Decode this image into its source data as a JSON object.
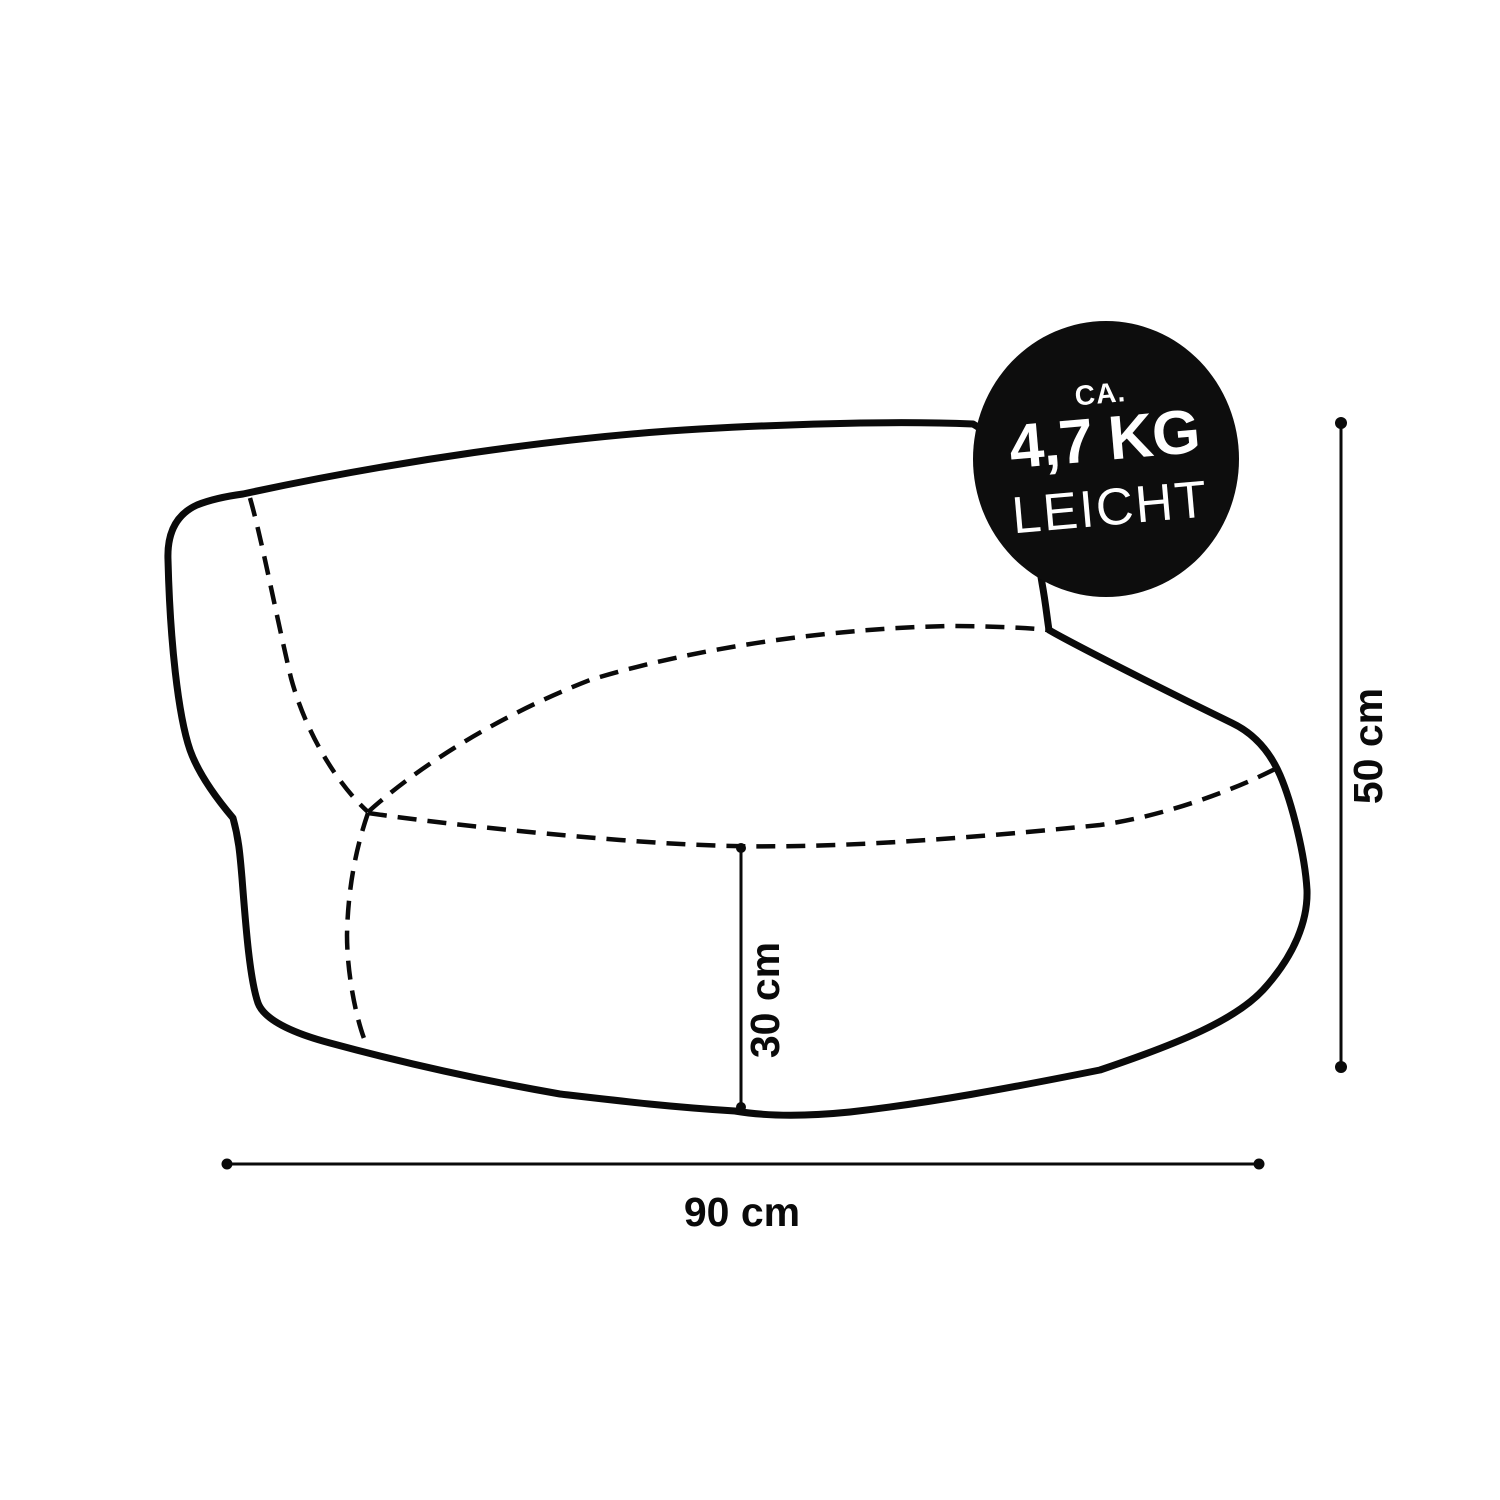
{
  "page": {
    "background_color": "#ffffff",
    "line_color": "#0a0a0a"
  },
  "badge": {
    "prefix": "CA.",
    "weight": "4,7 KG",
    "suffix": "LEICHT",
    "background_color": "#0d0d0d",
    "text_color": "#ffffff"
  },
  "dimensions": {
    "height": {
      "label": "50 cm",
      "orientation": "vertical"
    },
    "seat_height": {
      "label": "30 cm",
      "orientation": "vertical"
    },
    "width": {
      "label": "90 cm",
      "orientation": "horizontal"
    }
  }
}
